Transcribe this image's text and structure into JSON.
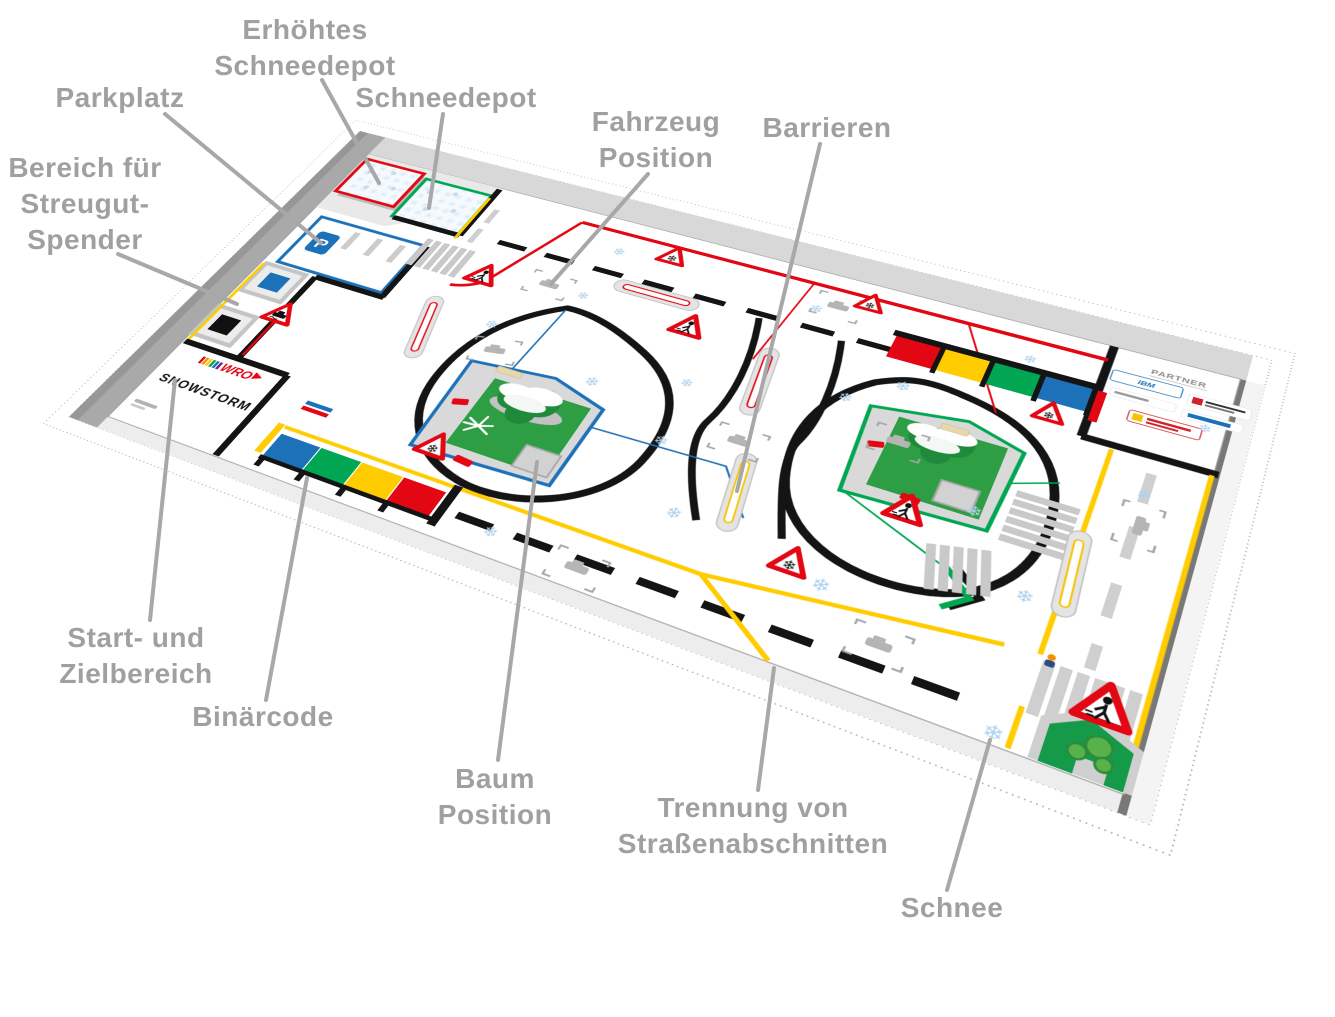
{
  "callouts": [
    {
      "id": "erhoehtes-schneedepot",
      "text": "Erhöhtes\nSchneedepot"
    },
    {
      "id": "parkplatz",
      "text": "Parkplatz"
    },
    {
      "id": "schneedepot",
      "text": "Schneedepot"
    },
    {
      "id": "bereich-streugut",
      "text": "Bereich für\nStreugut-\nSpender"
    },
    {
      "id": "fahrzeug-position",
      "text": "Fahrzeug\nPosition"
    },
    {
      "id": "barrieren",
      "text": "Barrieren"
    },
    {
      "id": "start-ziel",
      "text": "Start- und\nZielbereich"
    },
    {
      "id": "binaercode",
      "text": "Binärcode"
    },
    {
      "id": "baum-position",
      "text": "Baum\nPosition"
    },
    {
      "id": "trennung",
      "text": "Trennung von\nStraßenabschnitten"
    },
    {
      "id": "schnee",
      "text": "Schnee"
    }
  ],
  "mat": {
    "start_zone": {
      "logo": "WRO",
      "title": "SNOWSTORM"
    },
    "partner": {
      "title": "PARTNER",
      "sponsor": "IBM"
    },
    "parking": {
      "symbol": "P"
    }
  },
  "icons": {
    "snowflake": "❄"
  },
  "colors": {
    "red": "#e30613",
    "green": "#00a651",
    "blue": "#1d71b8",
    "yellow": "#ffcc00",
    "snow": "#aed2ee",
    "label": "#a0a0a0"
  }
}
